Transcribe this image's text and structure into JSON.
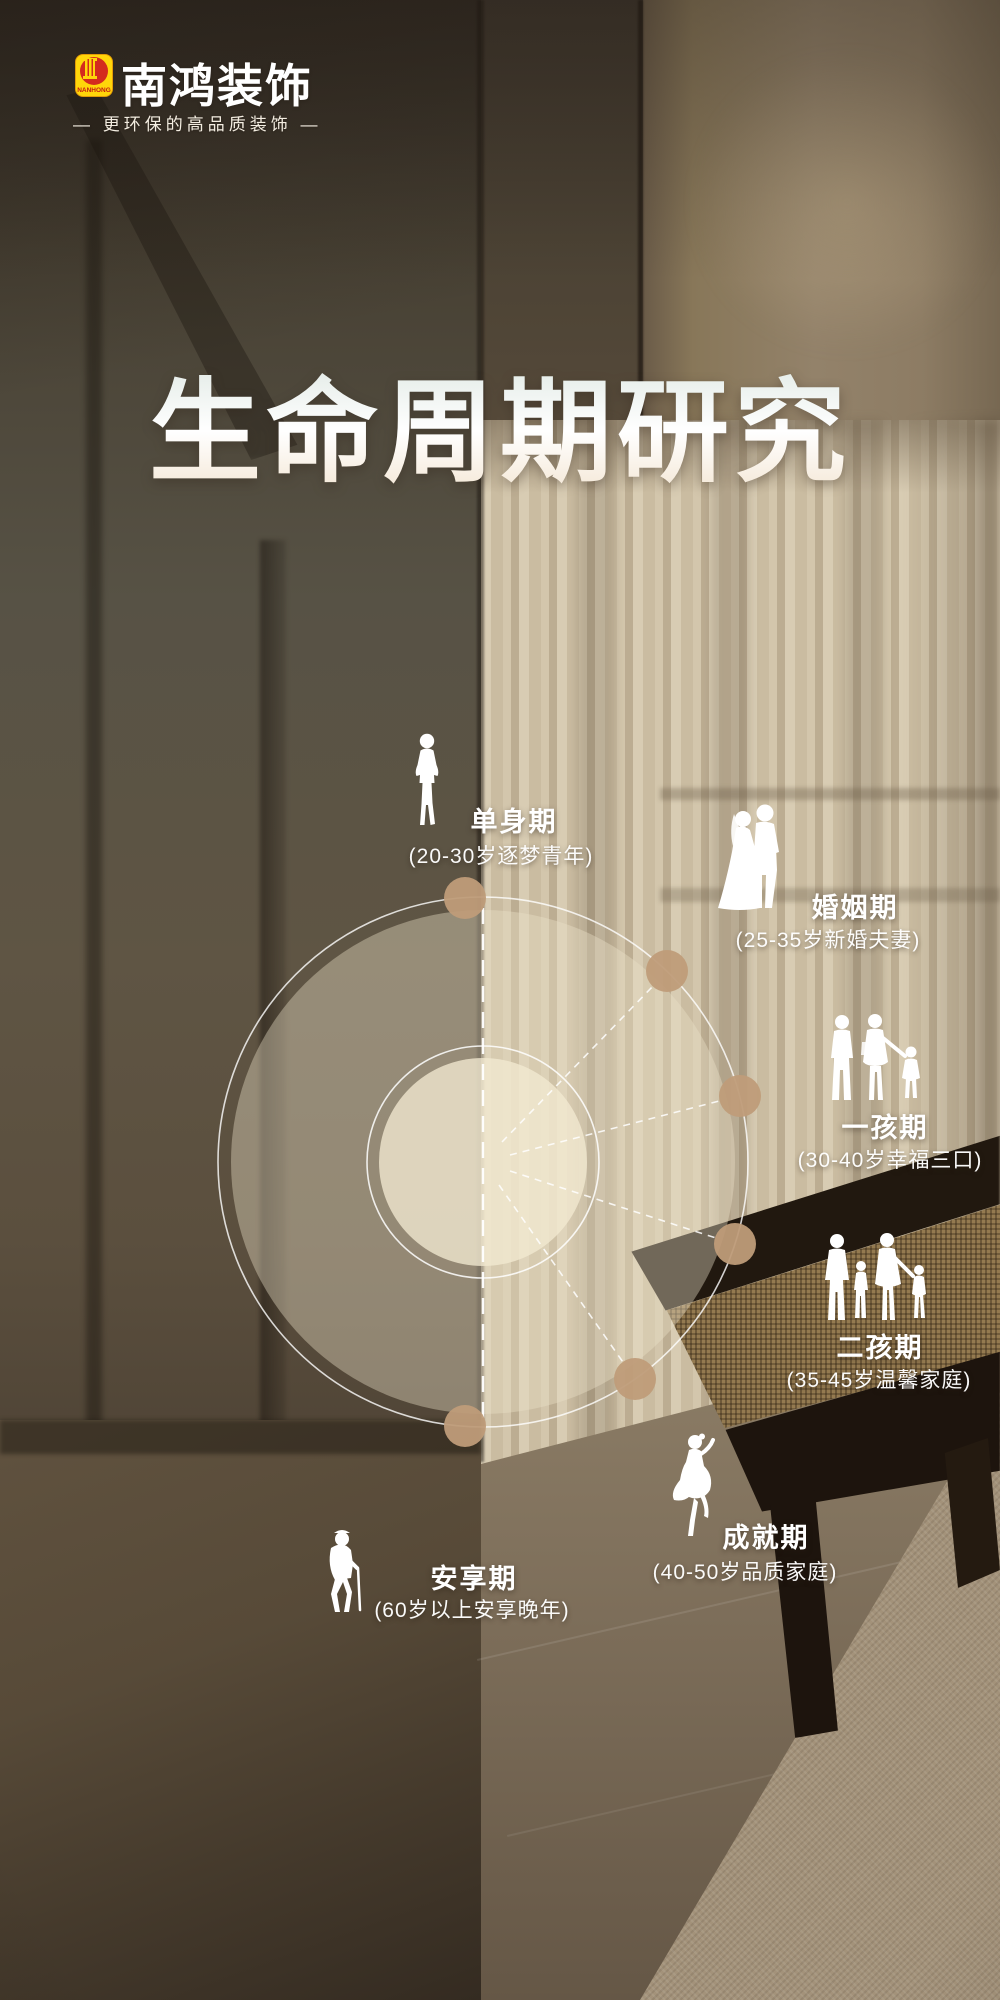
{
  "brand": {
    "logo_text": "NANHONG",
    "name": "南鸿装饰",
    "tagline": "— 更环保的高品质装饰 —"
  },
  "title": "生命周期研究",
  "stages": [
    {
      "id": "single",
      "label": "单身期",
      "desc": "(20-30岁逐梦青年)",
      "icon": "single-person-icon"
    },
    {
      "id": "marriage",
      "label": "婚姻期",
      "desc": "(25-35岁新婚夫妻)",
      "icon": "wedding-couple-icon"
    },
    {
      "id": "one-child",
      "label": "一孩期",
      "desc": "(30-40岁幸福三口)",
      "icon": "family-of-three-icon"
    },
    {
      "id": "two-child",
      "label": "二孩期",
      "desc": "(35-45岁温馨家庭)",
      "icon": "family-of-four-icon"
    },
    {
      "id": "achievement",
      "label": "成就期",
      "desc": "(40-50岁品质家庭)",
      "icon": "elegant-woman-icon"
    },
    {
      "id": "retirement",
      "label": "安享期",
      "desc": "(60岁以上安享晚年)",
      "icon": "elderly-with-cane-icon"
    }
  ],
  "colors": {
    "stage_dot": "#bf9c79",
    "ring_white": "#ffffff",
    "logo_yellow": "#ffd60a",
    "logo_red": "#d42b1e",
    "text_white": "#ffffff",
    "wall_dark": "#4a4033",
    "curtain_light": "#cfc2a8"
  }
}
